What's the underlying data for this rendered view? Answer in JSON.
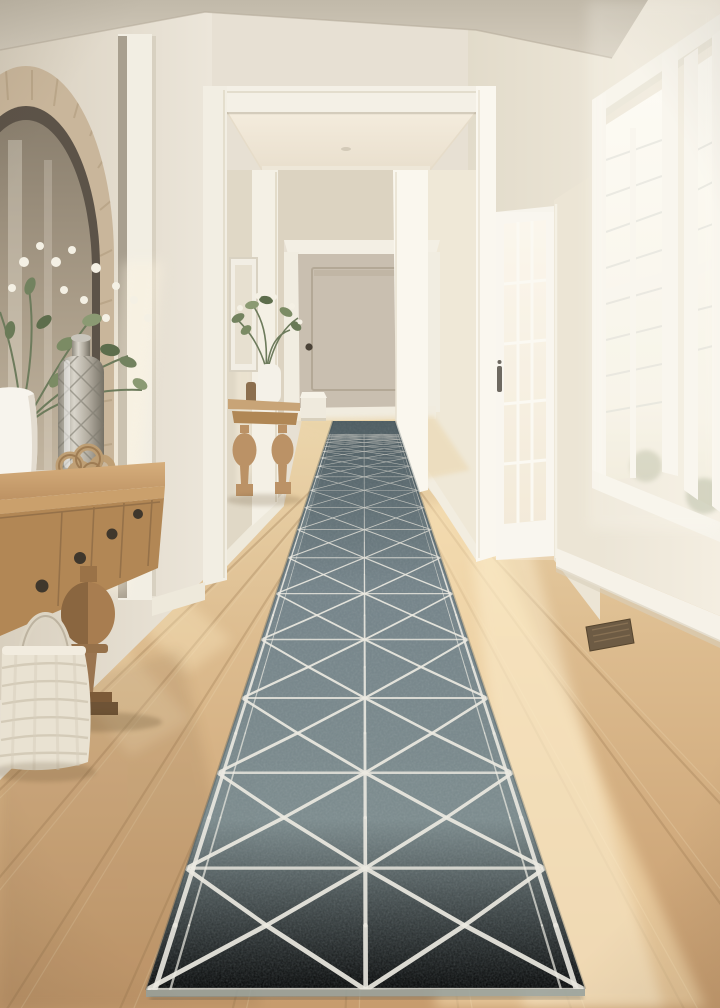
{
  "scene": {
    "description": "Sunlit hallway with light oak wood floors, cream walls and white trim. A long gray runner rug with a white geometric triangle-lattice pattern leads to a taupe paneled door. On the left, an arched rattan mirror hangs above an oak console table with a silver mercury-glass vase, white flowers, coral decor and a woven basket. On the right, a glazed white door and tall white windows flood the floor with warm sunlight.",
    "palette": {
      "wall": "#e7e0d3",
      "wall_shaded": "#d9d1c1",
      "ceiling": "#c7bfb0",
      "hall_ceiling": "#f0e8da",
      "trim_white": "#f6f3ea",
      "floor_wood": "#cfa97a",
      "floor_sunlit": "#f3e2bb",
      "plank_seam": "#9c7a50",
      "rug_base": "#78878b",
      "rug_dark": "#5e6e72",
      "rug_pattern": "#ebe9e1",
      "far_door": "#c9bfb0",
      "furniture_oak": "#b28755",
      "mirror_frame": "#c9b69b",
      "silver_vase": "#b7b2a7",
      "greenery": "#72825f",
      "blossom": "#f4f0e4",
      "basket": "#e9e2d2",
      "vent": "#6d5b44",
      "hardware": "#3e382f"
    }
  }
}
